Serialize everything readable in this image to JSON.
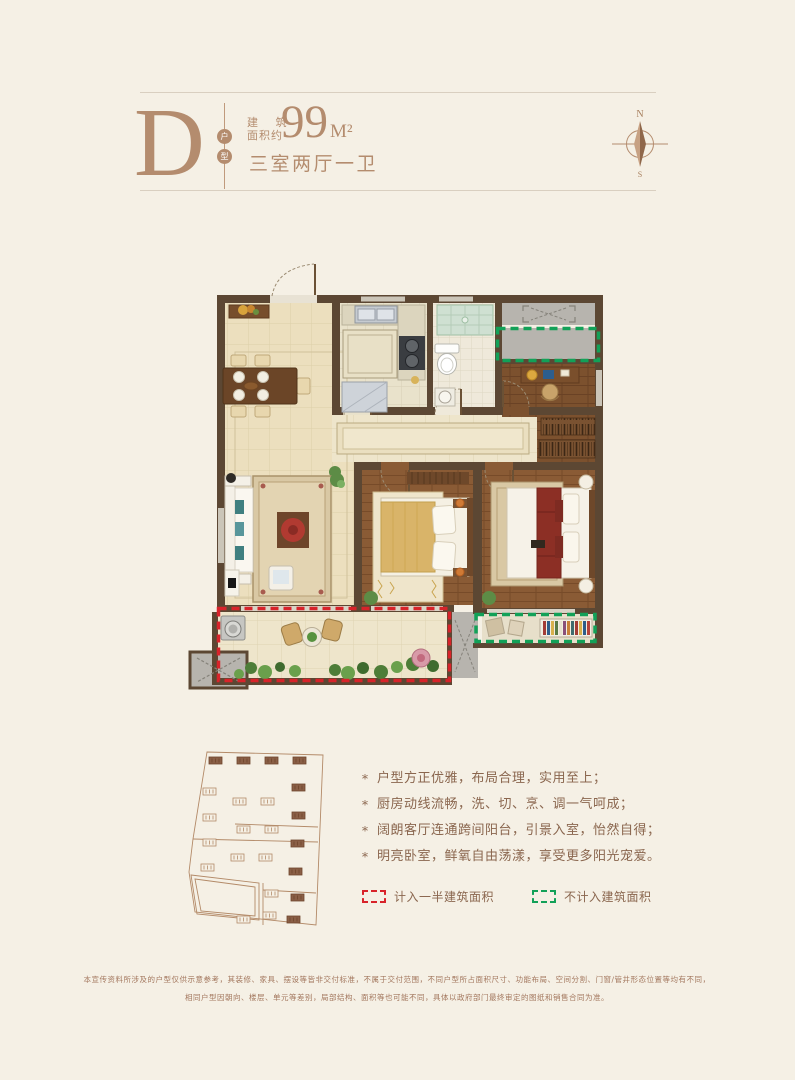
{
  "colors": {
    "background": "#f5f0e5",
    "accent_tan": "#b48c6e",
    "text_brown": "#8a664e",
    "legend_red": "#d8232a",
    "legend_green": "#12a158",
    "wall_brown": "#5c4733"
  },
  "header": {
    "unit_letter": "D",
    "unit_type_chars": [
      "户",
      "型"
    ],
    "area_prefix_line1": "建 筑",
    "area_prefix_line2": "面积约",
    "area_value": "99",
    "area_unit": "M²",
    "layout_desc": "三室两厅一卫"
  },
  "compass": {
    "north": "N",
    "south": "S"
  },
  "features": {
    "marker": "*",
    "items": [
      {
        "text": "户型方正优雅，布局合理，实用至上；"
      },
      {
        "text": "厨房动线流畅，洗、切、烹、调一气呵成；"
      },
      {
        "text": "阔朗客厅连通跨间阳台，引景入室，怡然自得；"
      },
      {
        "text": "明亮卧室，鲜氧自由荡漾，享受更多阳光宠爱。"
      }
    ]
  },
  "legend": {
    "half_area_label": "计入一半建筑面积",
    "excluded_label": "不计入建筑面积"
  },
  "disclaimer": {
    "line1": "本宣传资料所涉及的户型仅供示意参考，其装修、家具、摆设等皆非交付标准，不属于交付范围，不同户型所占面积尺寸、功能布局、空间分割、门窗/管井形态位置等均有不同，",
    "line2": "相同户型因朝向、楼层、单元等差别，局部结构、面积等也可能不同，具体以政府部门最终审定的图纸和销售合同为准。"
  }
}
